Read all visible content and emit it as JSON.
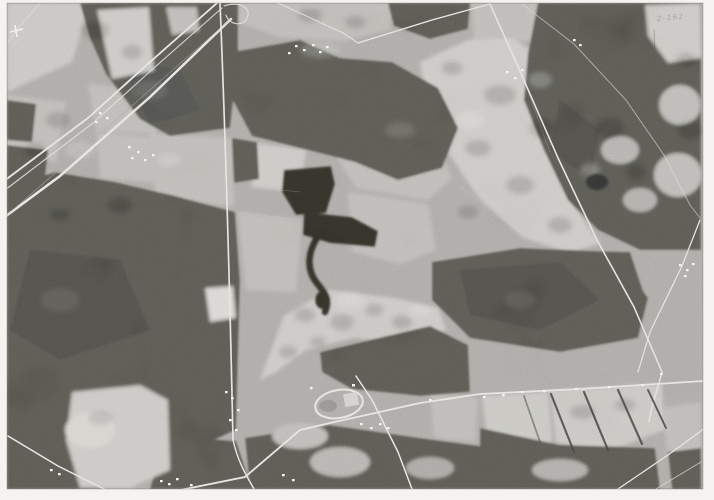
{
  "meta": {
    "title": "Monochrome aerial survey photograph",
    "subject": "Rural landscape: woodland blocks, crop fields, crossing roads, a railroad corridor, farm ponds, a stream and a small oval racetrack"
  },
  "annotation": {
    "photo_index": "2-162"
  },
  "palette": {
    "paper": "#f4f3ef",
    "base": "#8e8c87",
    "forest": "#3b3a35",
    "forest-deep": "#302f2b",
    "field-light": "#b6b4ae",
    "field-med": "#a3a19b",
    "road": "#dcdad4",
    "water": "#1b1b19",
    "building": "#efeee8",
    "hedge": "#2c2b28",
    "mark": "#4a4843"
  },
  "features": {
    "photo": "aerial photograph",
    "fields": "farm fields and pasture",
    "woodland": "dark woodland blocks",
    "roads": "rural roads",
    "railroad": "railroad and parallel highway",
    "ponds": "farm ponds",
    "stream": "stream channel",
    "racetrack": "oval training track",
    "buildings": "farmsteads and buildings",
    "border": "white photo border",
    "scratches": "film scratches and index mark"
  }
}
